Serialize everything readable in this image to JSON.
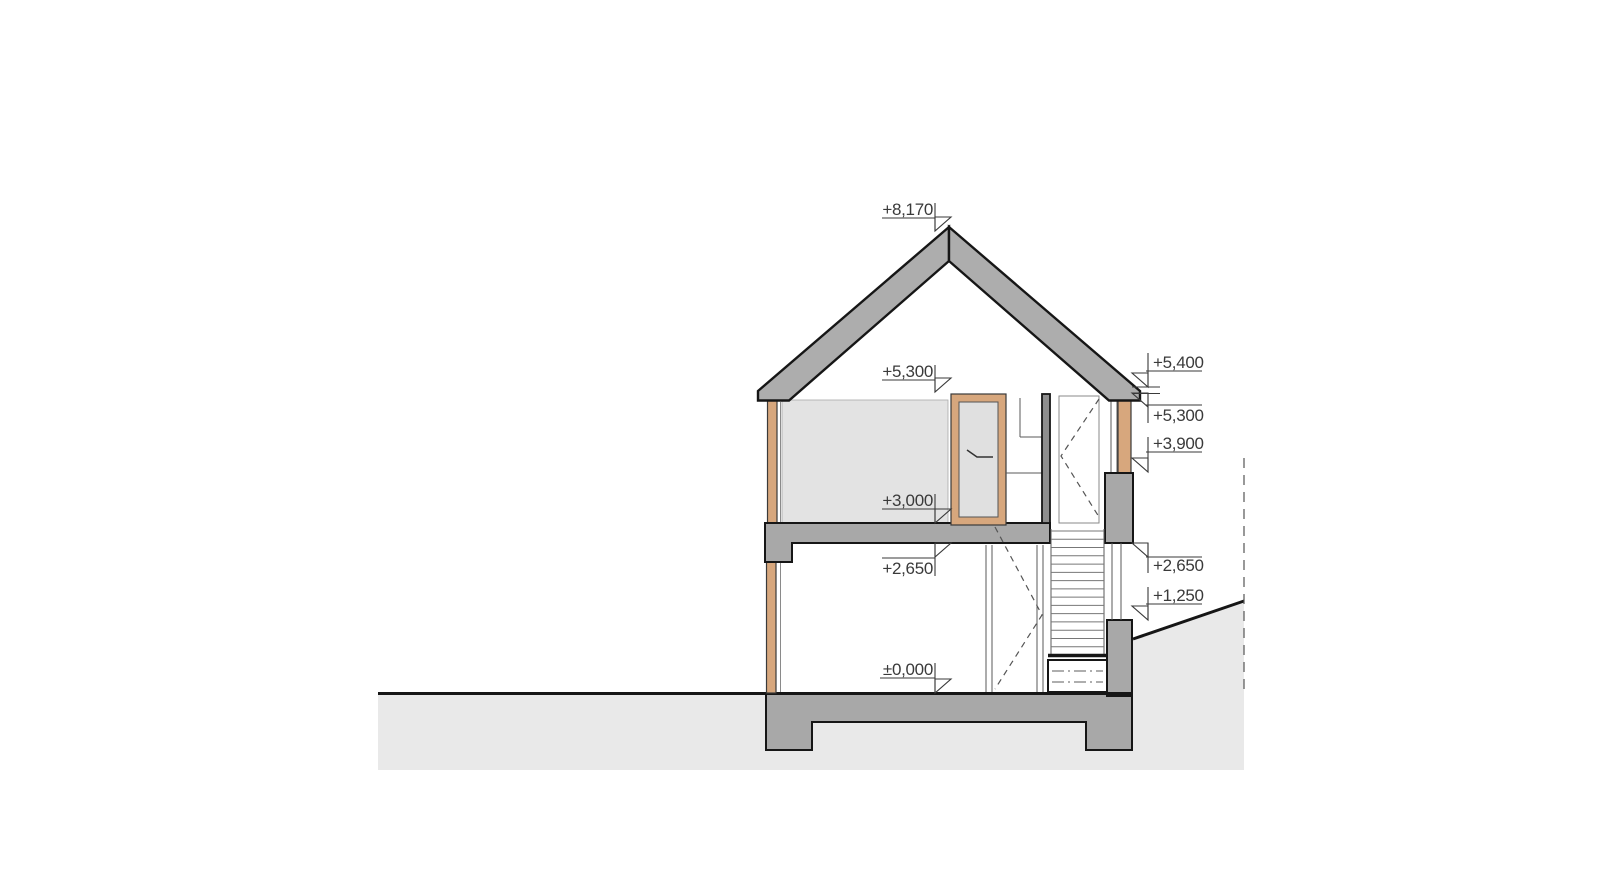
{
  "drawing": {
    "kind": "house-cross-section",
    "levels_left": [
      {
        "id": "ridge",
        "label": "+8,170"
      },
      {
        "id": "wall-top",
        "label": "+5,300"
      },
      {
        "id": "upper-floor",
        "label": "+3,000"
      },
      {
        "id": "gf-ceiling",
        "label": "+2,650"
      },
      {
        "id": "gf-floor",
        "label": "±0,000"
      }
    ],
    "levels_right": [
      {
        "id": "eave-top",
        "label": "+5,400"
      },
      {
        "id": "eave-bottom",
        "label": "+5,300"
      },
      {
        "id": "lintel-top",
        "label": "+3,900"
      },
      {
        "id": "gf-ceiling",
        "label": "+2,650"
      },
      {
        "id": "terrain",
        "label": "+1,250"
      }
    ],
    "stairs": {
      "tread_count": 16,
      "x1": 1051,
      "x2": 1104,
      "y_top": 531,
      "y_bottom": 655
    },
    "colors": {
      "cut_structure": "#a8a8a8",
      "roof": "#adadad",
      "inner_partition": "#8e8e8e",
      "timber": "#d7a77d",
      "interior_wall_face": "#e3e3e3",
      "terrain": "#e9e9e9",
      "door_panel": "#e0e0e0",
      "outline": "#161616",
      "text": "#3a3a3a"
    }
  }
}
